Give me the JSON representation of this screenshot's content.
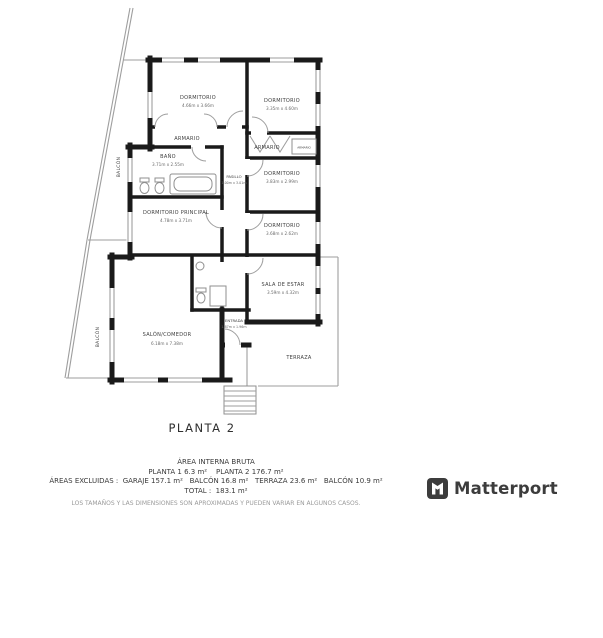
{
  "title": "PLANTA 2",
  "rooms": {
    "dormitorio1": {
      "name": "DORMITORIO",
      "dims": "4.66m x 3.66m"
    },
    "dormitorio2": {
      "name": "DORMITORIO",
      "dims": "3.35m x 4.60m"
    },
    "armario1": {
      "name": "ARMARIO"
    },
    "bano": {
      "name": "BAÑO",
      "dims": "3.71m x 2.55m"
    },
    "armario2": {
      "name": "ARMARIO"
    },
    "armario3": {
      "name": "ARMARIO"
    },
    "pasillo": {
      "name": "PASILLO",
      "dims": "1.00m x 3.01m"
    },
    "dormitorio3": {
      "name": "DORMITORIO",
      "dims": "3.83m x 2.99m"
    },
    "dormitorio4": {
      "name": "DORMITORIO",
      "dims": "3.68m x 2.62m"
    },
    "principal": {
      "name": "DORMITORIO PRINCIPAL",
      "dims": "4.78m x 3.71m"
    },
    "sala": {
      "name": "SALA DE ESTAR",
      "dims": "3.59m x 4.32m"
    },
    "salon": {
      "name": "SALÓN/COMEDOR",
      "dims": "6.18m x 7.38m"
    },
    "entrada": {
      "name": "ENTRADA",
      "dims": "1.87m x 1.96m"
    },
    "terraza": {
      "name": "TERRAZA"
    },
    "balcon1": {
      "name": "BALCÓN"
    },
    "balcon2": {
      "name": "BALCÓN"
    }
  },
  "footer": {
    "line1": "ÁREA INTERNA BRUTA",
    "line2": "PLANTA 1 6.3 m²    PLANTA 2 176.7 m²",
    "line3": "ÁREAS EXCLUIDAS :  GARAJE 157.1 m²   BALCÓN 16.8 m²   TERRAZA 23.6 m²   BALCÓN 10.9 m²",
    "line4": "TOTAL :  183.1 m²",
    "disclaimer": "LOS TAMAÑOS Y LAS DIMENSIONES SON APROXIMADAS Y PUEDEN VARIAR EN ALGUNOS CASOS."
  },
  "branding": {
    "logo_text": "Matterport"
  },
  "colors": {
    "wall": "#1a1a1a",
    "thin_line": "#9e9e9e",
    "label": "#3d3d3d",
    "logo": "#3c3c3c"
  }
}
